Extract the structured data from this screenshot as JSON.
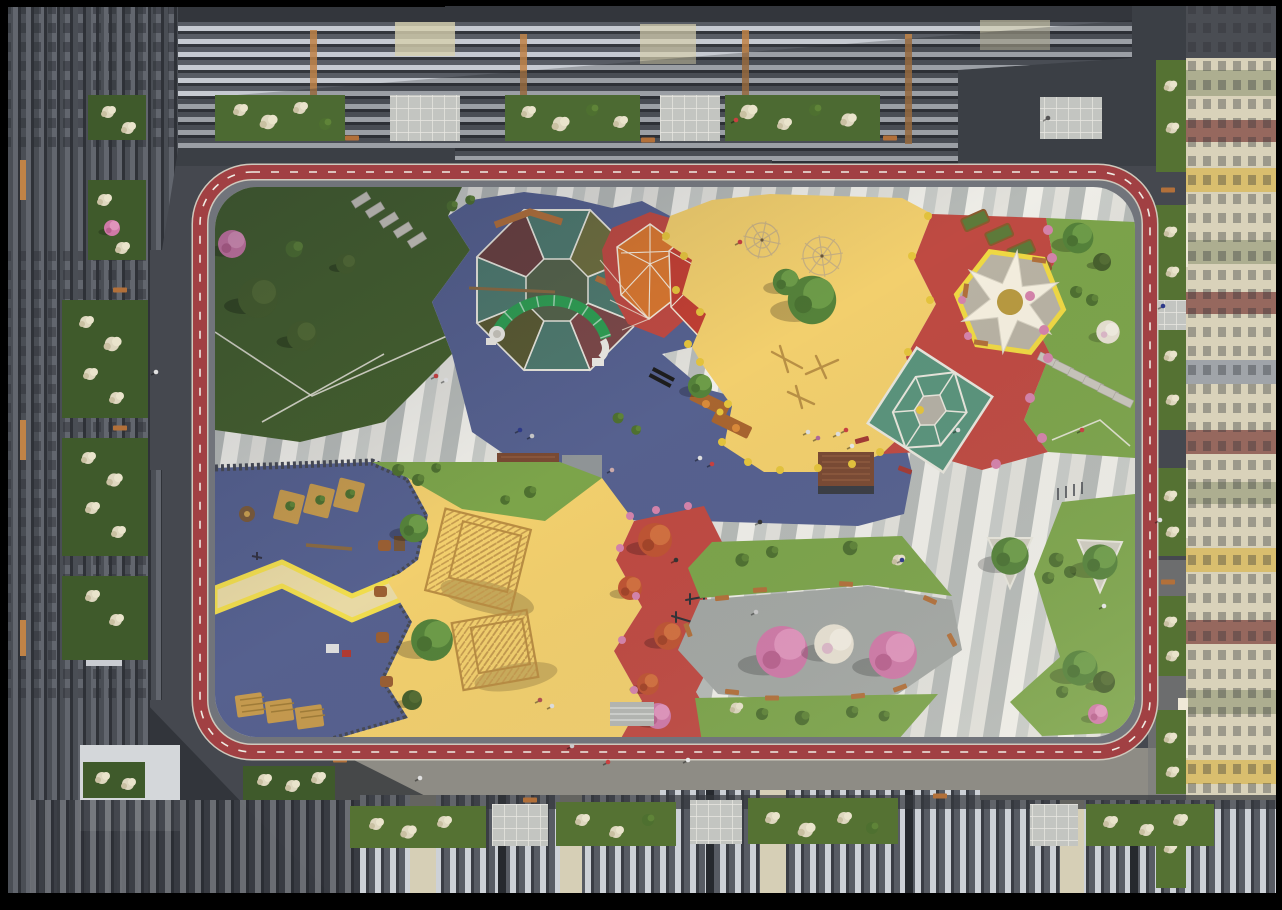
{
  "scene": {
    "subject": "aerial-top-down-residential-courtyard-playground-render",
    "time_of_day": "day",
    "no_visible_text": true
  },
  "palette": {
    "frame": "#000000",
    "asphalt": "#45484f",
    "road_shadow": "#2e3136",
    "sidewalk_sun": "#8e8c85",
    "walkway": "#71747b",
    "track_red": "#a14043",
    "track_edge": "#cfc9bd",
    "track_dash": "#efece4",
    "lawn": "#7ca44a",
    "lawn_shade": "#45602d",
    "play_blue": "#56618f",
    "play_yellow": "#f2cf6d",
    "play_red": "#bf4a42",
    "gem_orange": "#d9772f",
    "gem_red": "#c23f33",
    "court_teal": "#5a947c",
    "canopy_white": "#f5efdf",
    "canopy_gold": "#b89a40",
    "canopy_ring": "#f0d943",
    "sand": "#e8d9a4",
    "zigzag_yellow": "#f0dc4e",
    "wood": "#c49a4e",
    "bench_wood": "#b2703a",
    "corten_brown": "#7a4a33",
    "plaza_gray": "#a3a7a3",
    "flower_yellow": "#e5c43c",
    "flower_pink": "#d583ab",
    "tree_green": "#55823a",
    "tree_dark": "#47602c",
    "tree_pink": "#cf79a7",
    "tree_autumn": "#c25a35",
    "tree_white": "#e7e1d2",
    "bush_pale": "#ded7bf",
    "bldg_dark": "#4a4e56",
    "bldg_stripe": "#c6cad1",
    "bldg_accent": "#c08347",
    "bldg_cream": "#d9d2ba",
    "mosaic_teal": "#4f7a6e",
    "mosaic_olive": "#6e6e3e",
    "mosaic_maroon": "#7c4848",
    "arc_green": "#2f9e52"
  },
  "zones": [
    {
      "name": "running-track-loop",
      "color_key": "track_red"
    },
    {
      "name": "lawn-northwest",
      "color_key": "lawn_shade"
    },
    {
      "name": "playground-blue-north",
      "color_key": "play_blue"
    },
    {
      "name": "mosaic-octagon-court",
      "color_key": "mosaic_teal"
    },
    {
      "name": "gem-climber-orange",
      "color_key": "gem_orange"
    },
    {
      "name": "gem-climber-red",
      "color_key": "gem_red"
    },
    {
      "name": "playground-yellow-north",
      "color_key": "play_yellow"
    },
    {
      "name": "playground-red-northeast",
      "color_key": "play_red"
    },
    {
      "name": "canopy-pavilion",
      "color_key": "canopy_white"
    },
    {
      "name": "sport-court-teal",
      "color_key": "court_teal"
    },
    {
      "name": "lawn-east",
      "color_key": "lawn"
    },
    {
      "name": "playground-blue-southwest",
      "color_key": "play_blue"
    },
    {
      "name": "playground-yellow-south",
      "color_key": "play_yellow"
    },
    {
      "name": "fitness-zone-red-south",
      "color_key": "play_red"
    },
    {
      "name": "plaza-southeast-pink-trees",
      "color_key": "plaza_gray"
    },
    {
      "name": "central-striped-promenade",
      "color_key": "track_edge"
    }
  ]
}
